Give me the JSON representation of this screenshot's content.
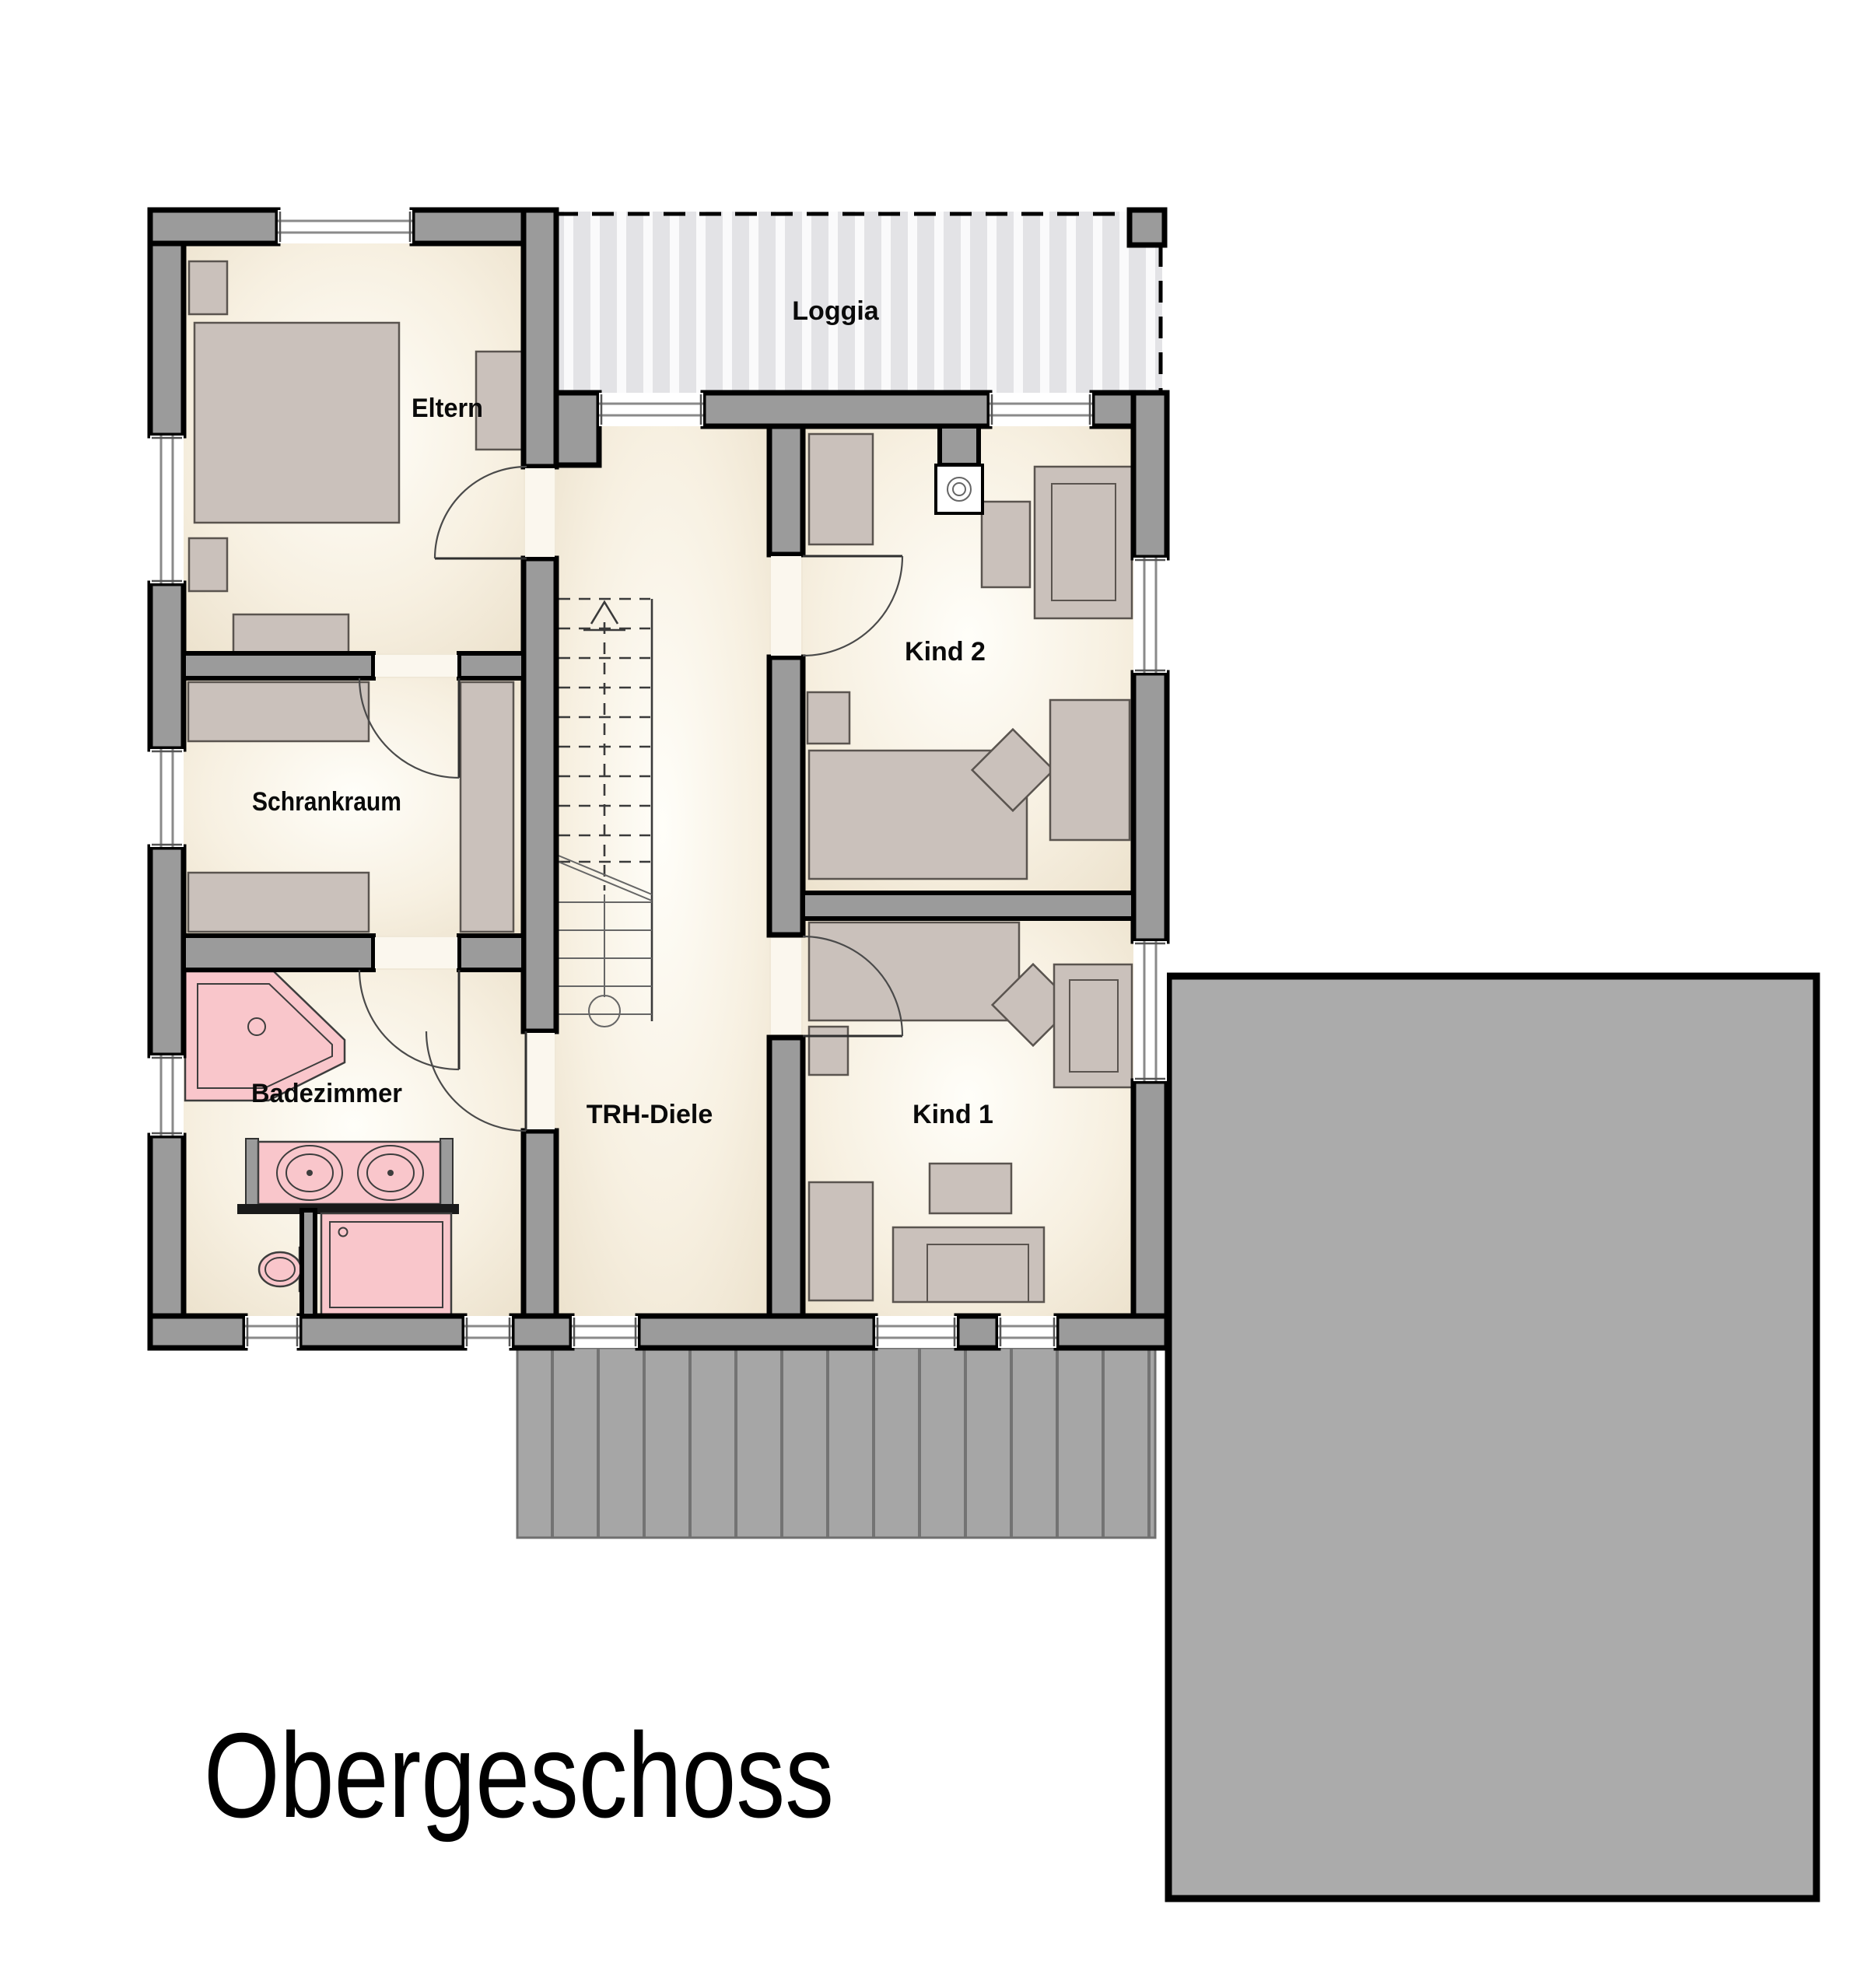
{
  "title": "Obergeschoss",
  "rooms": {
    "eltern": {
      "label": "Eltern"
    },
    "schrankraum": {
      "label": "Schrankraum"
    },
    "badezimmer": {
      "label": "Badezimmer"
    },
    "trh": {
      "label": "TRH-Diele"
    },
    "kind2": {
      "label": "Kind 2"
    },
    "kind1": {
      "label": "Kind 1"
    },
    "loggia": {
      "label": "Loggia"
    }
  },
  "stairs": {
    "direction_arrow": "up"
  },
  "colors": {
    "wall_gray": "#9b9b9b",
    "floor_cream": "#f3ecdc",
    "fixture_pink": "#f9c6cb",
    "furniture_gray": "#cac1bb",
    "roof_gray": "#ababab",
    "terrace_gray": "#a6a6a6",
    "loggia_stripe_bg": "#e3e3e6",
    "outline_black": "#000000"
  }
}
